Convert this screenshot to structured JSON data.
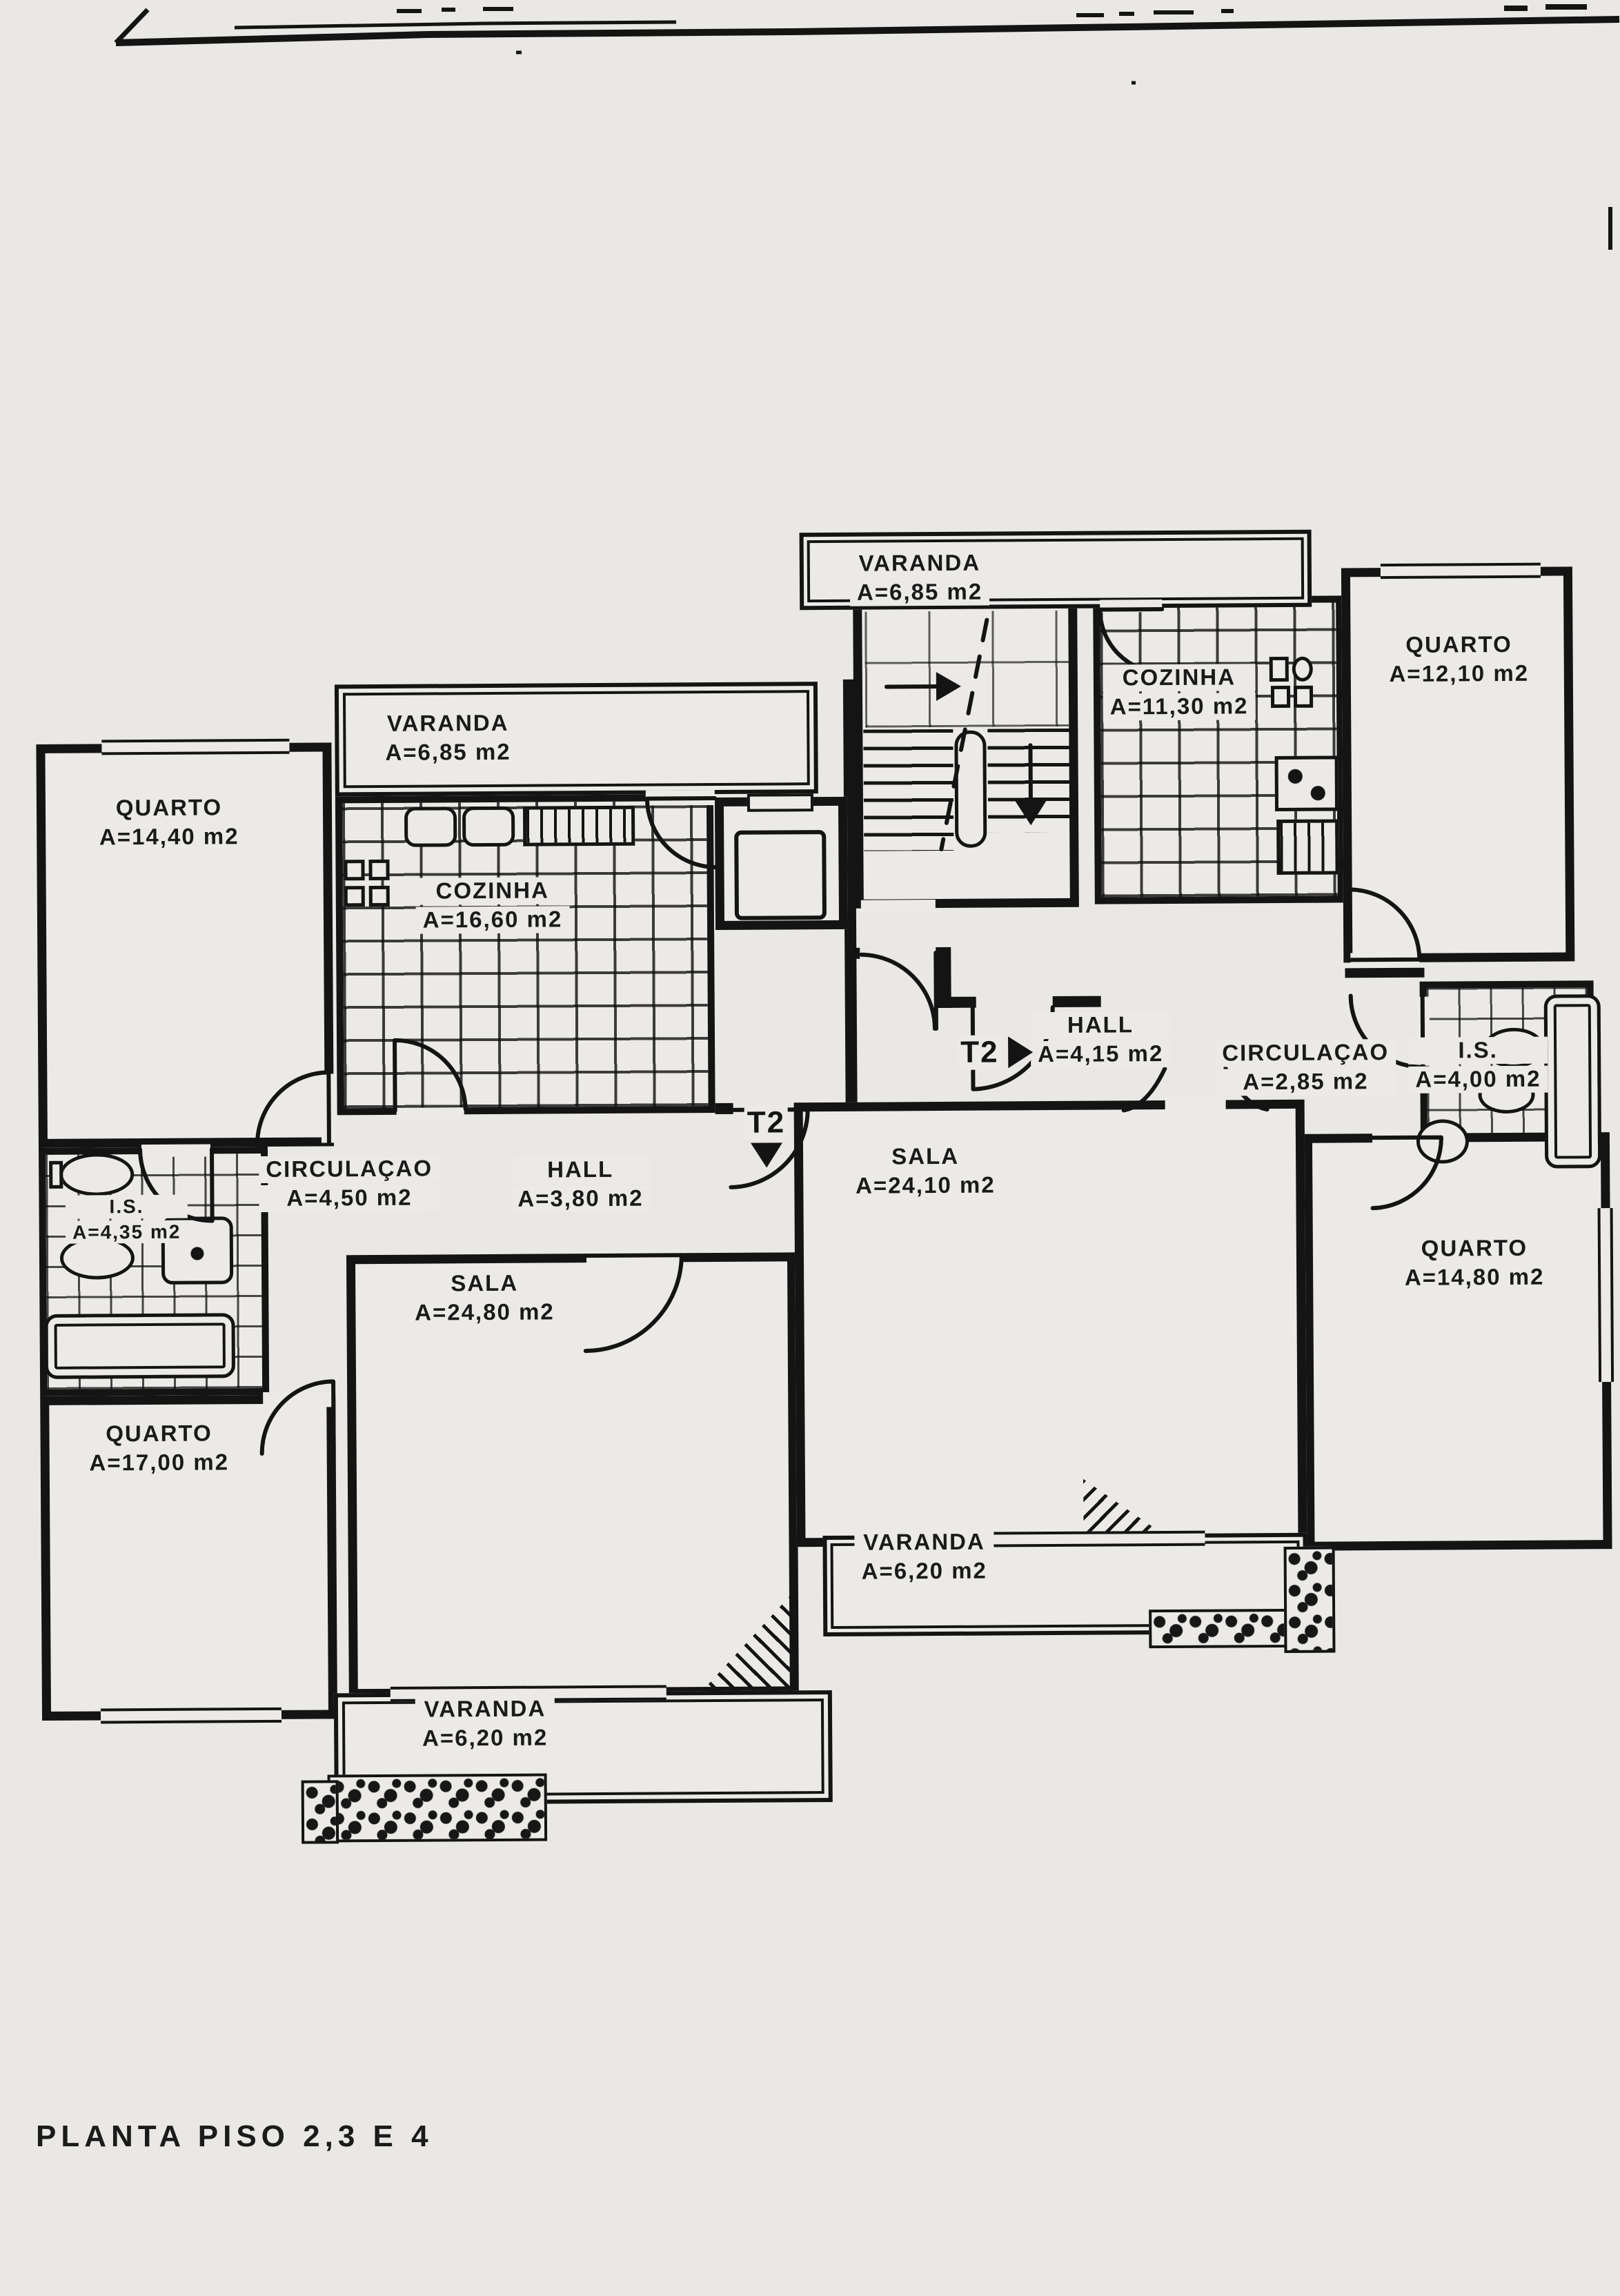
{
  "page": {
    "title": "PLANTA PISO 2,3 E 4",
    "paper_color": "#eae8e5",
    "ink_color": "#141414"
  },
  "plan": {
    "markers": {
      "t2_right": "T2",
      "t2_left": "T2"
    },
    "rooms": {
      "varanda_top": {
        "name": "VARANDA",
        "area": "A=6,85 m2"
      },
      "quarto_ne": {
        "name": "QUARTO",
        "area": "A=12,10 m2"
      },
      "cozinha_right": {
        "name": "COZINHA",
        "area": "A=11,30 m2"
      },
      "varanda_left": {
        "name": "VARANDA",
        "area": "A=6,85 m2"
      },
      "quarto_nw": {
        "name": "QUARTO",
        "area": "A=14,40 m2"
      },
      "cozinha_left": {
        "name": "COZINHA",
        "area": "A=16,60 m2"
      },
      "hall_right": {
        "name": "HALL",
        "area": "A=4,15 m2"
      },
      "circulacao_right": {
        "name": "CIRCULAÇAO",
        "area": "A=2,85 m2"
      },
      "is_right": {
        "name": "I.S.",
        "area": "A=4,00 m2"
      },
      "sala_right": {
        "name": "SALA",
        "area": "A=24,10 m2"
      },
      "circulacao_left": {
        "name": "CIRCULAÇAO",
        "area": "A=4,50 m2"
      },
      "hall_left": {
        "name": "HALL",
        "area": "A=3,80 m2"
      },
      "is_left": {
        "name": "I.S.",
        "area": "A=4,35 m2"
      },
      "sala_left": {
        "name": "SALA",
        "area": "A=24,80 m2"
      },
      "quarto_e": {
        "name": "QUARTO",
        "area": "A=14,80 m2"
      },
      "quarto_sw": {
        "name": "QUARTO",
        "area": "A=17,00 m2"
      },
      "varanda_right": {
        "name": "VARANDA",
        "area": "A=6,20 m2"
      },
      "varanda_bottom": {
        "name": "VARANDA",
        "area": "A=6,20 m2"
      }
    }
  }
}
